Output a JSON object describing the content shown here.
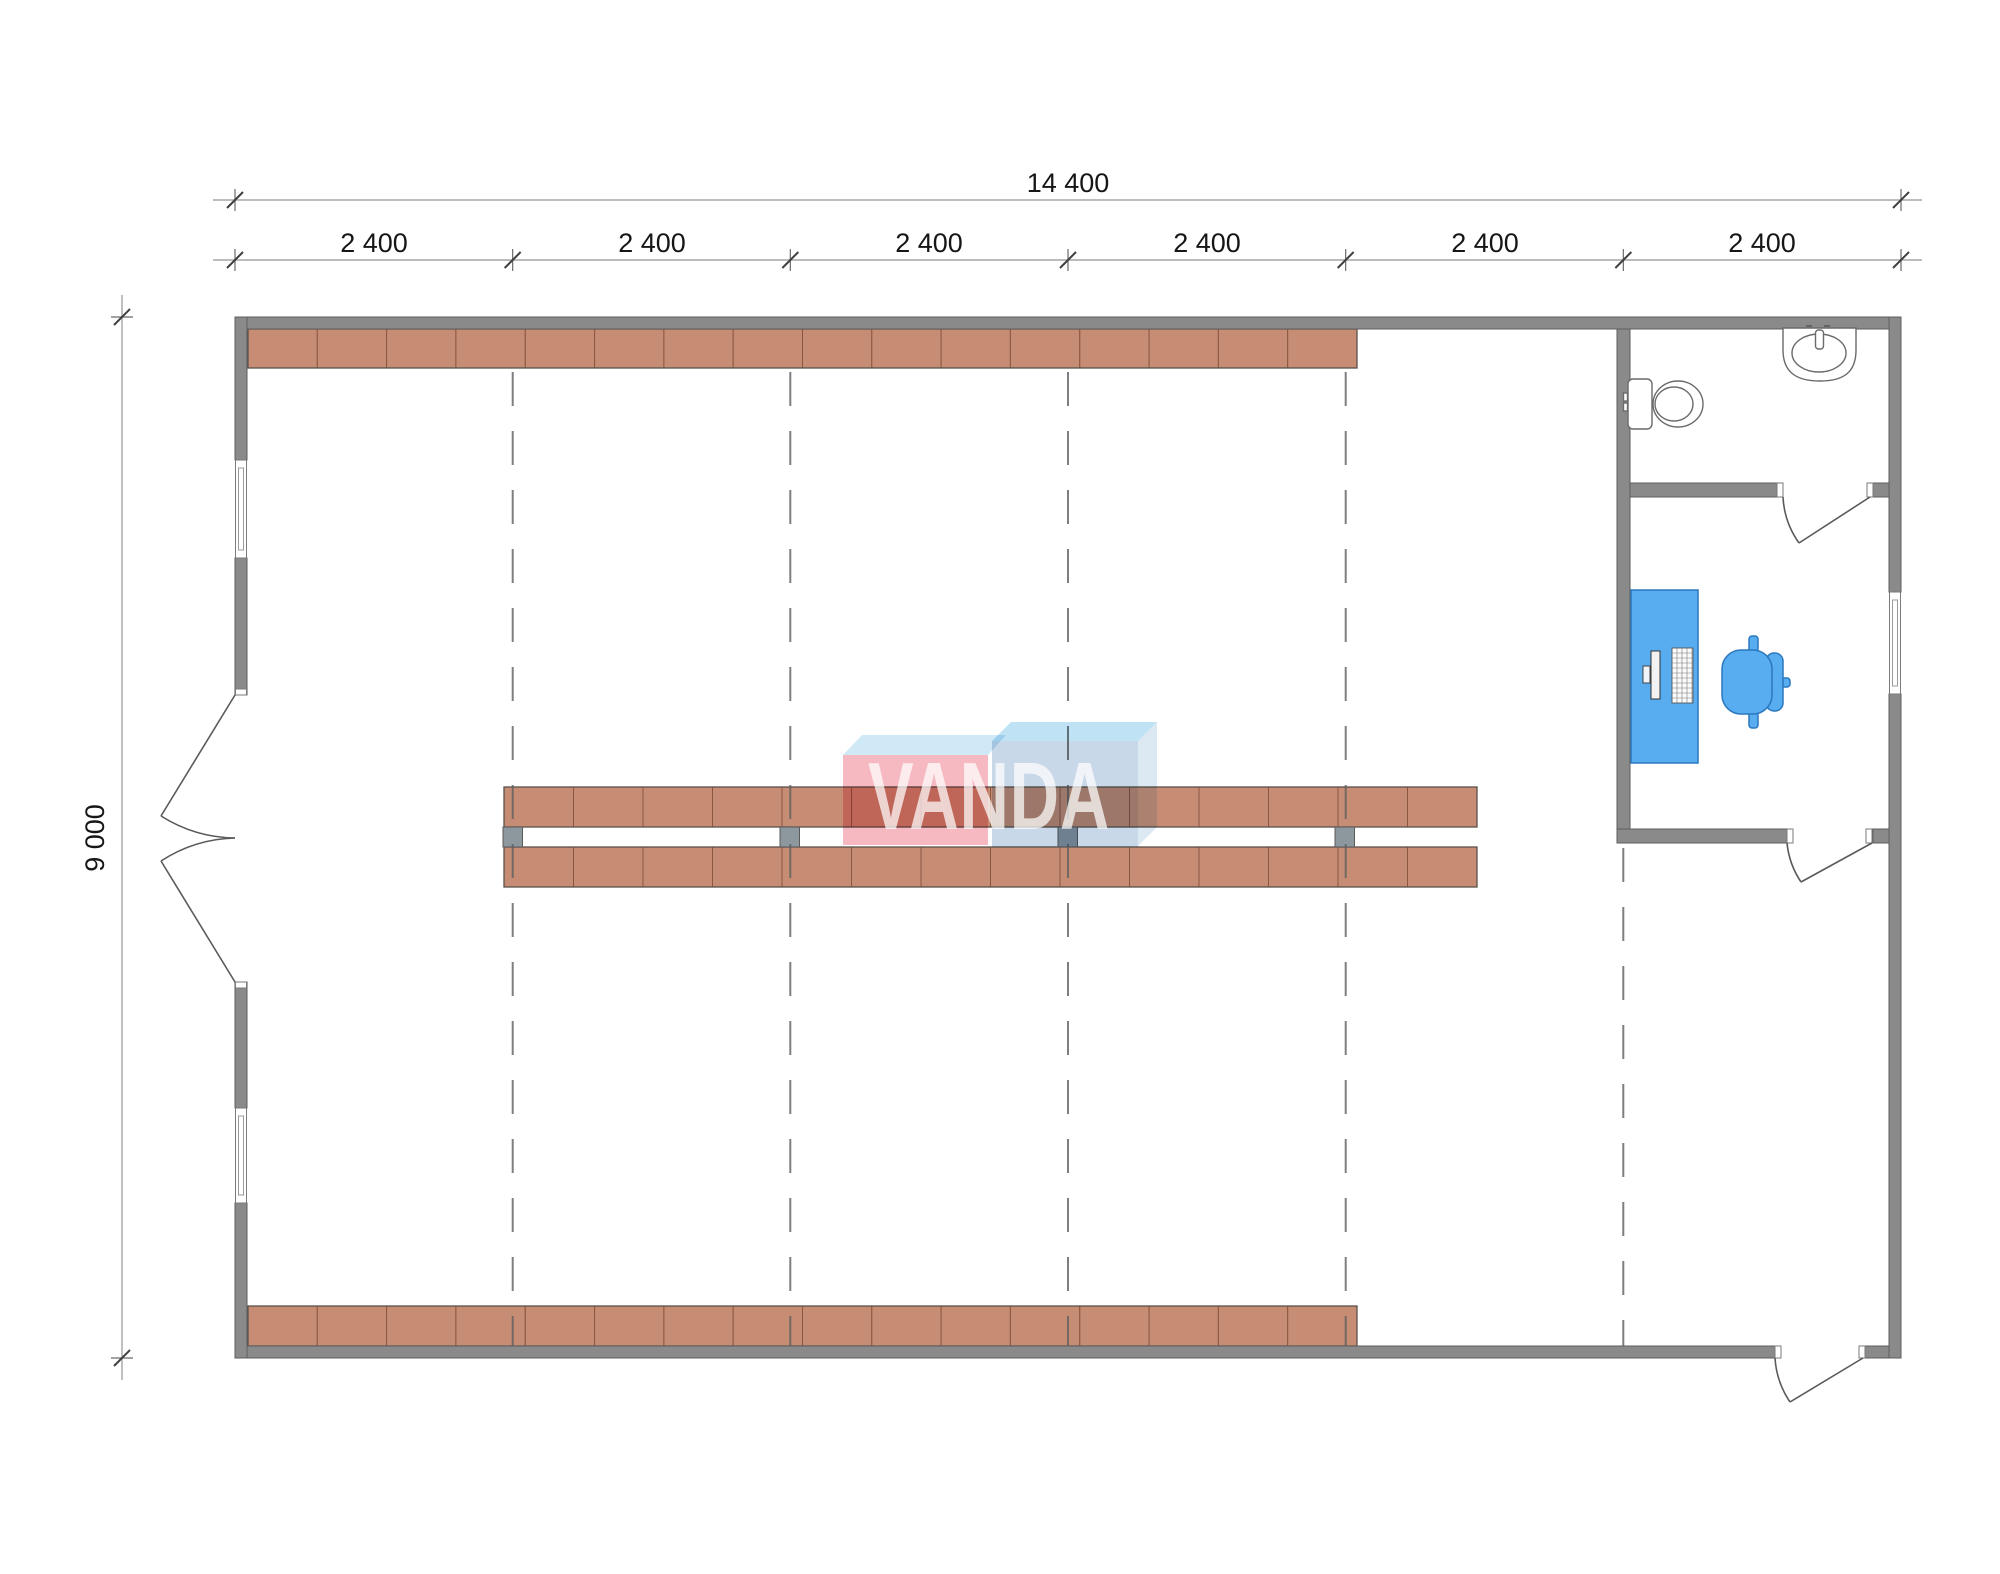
{
  "drawing": {
    "type": "floor-plan",
    "watermark_text": "VANDA"
  },
  "dimensions": {
    "total_width": "14 400",
    "height": "9 000",
    "bays": [
      "2 400",
      "2 400",
      "2 400",
      "2 400",
      "2 400",
      "2 400"
    ]
  },
  "shelving": {
    "top_row_segments": 16,
    "bottom_row_segments": 16,
    "middle_upper_segments": 14,
    "middle_lower_segments": 14,
    "middle_connectors": 4
  },
  "grid": {
    "bay_line_count": 5
  },
  "fixtures": {
    "bathroom": [
      "toilet",
      "sink"
    ],
    "office": [
      "desk",
      "monitor",
      "keyboard",
      "office-chair"
    ]
  },
  "colors": {
    "wall": "#8a8a8a",
    "wall_edge": "#5e5e5e",
    "shelf": "#c68d74",
    "shelf_edge": "#8a5743",
    "shelf_outline": "#5a5049",
    "connector": "#8d979e",
    "dash_line": "#5f5f5f",
    "dim_line": "#a5a5a5",
    "dim_tick": "#3f3f3f",
    "dim_text": "#161616",
    "fixture_line": "#6a6a6a",
    "furniture_fill": "#58acf0",
    "furniture_edge": "#2a78bd",
    "logo_pink": "#f6b9c2",
    "logo_sky": "#cfe9f6",
    "logo_blue_top": "#bfe3f5",
    "logo_blue_front": "#c9d8e8",
    "logo_blue_side": "#dce9f3",
    "logo_text": "#ffffff"
  }
}
